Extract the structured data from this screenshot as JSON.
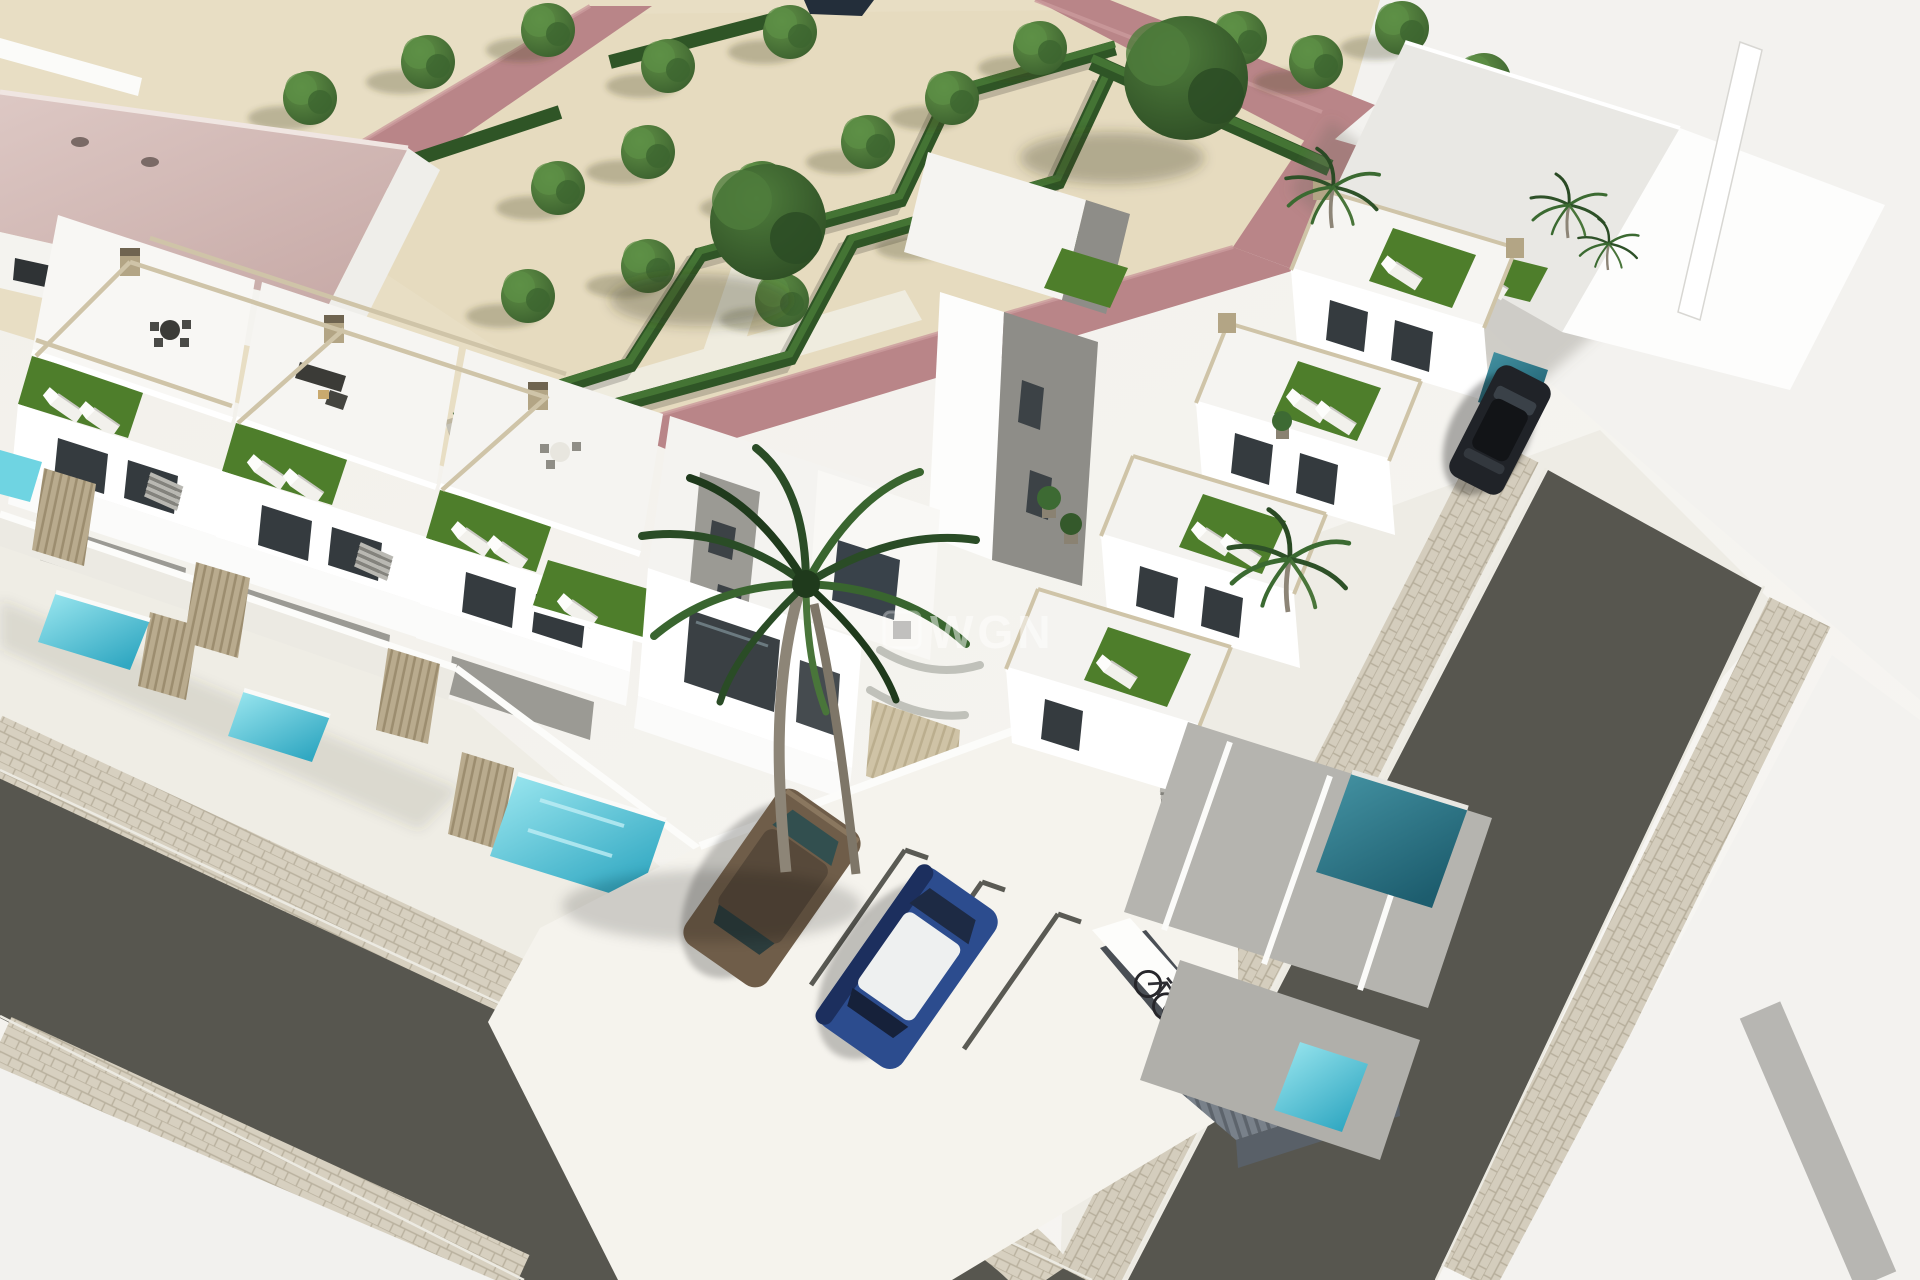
{
  "scene": {
    "type": "architectural-3d-render",
    "description": "Aerial 3D render of a new-build residential complex: two diagonal rows of modern white townhouses with rooftop solarium terraces (artificial turf, sun loungers, rattan sofas, pergola frames), private turquoise plunge pools behind slatted fences, a landscaped park with zig-zag hedges, gravel and dusty-pink paths, a corner street intersection with paver sidewalks, parked cars, bicycles and palm trees.",
    "watermark": {
      "text": "WGN",
      "opacity": 0.5
    },
    "inventory": {
      "townhouses_left_row": 4,
      "townhouses_right_row": 4,
      "plunge_pools": 7,
      "rooftop_turf_terraces": 9,
      "palm_trees": 6,
      "park_trees_small": 20,
      "park_trees_large": 2,
      "bicycles": 3,
      "streets": 2,
      "cars": [
        {
          "id": "car-bronze",
          "color_name": "bronze-brown"
        },
        {
          "id": "car-blue",
          "color_name": "blue with white roof"
        },
        {
          "id": "car-black",
          "color_name": "black"
        }
      ]
    }
  },
  "palette": {
    "sand": "#e8dec4",
    "parkInner": "#e6dbbf",
    "pathPink": "#b98588",
    "hedge": "#2f5526",
    "hedgeLight": "#447434",
    "roofMauve": "#d5bebb",
    "wallWhite": "#ffffff",
    "wallLight": "#f6f5f2",
    "wallShade": "#d6d5d1",
    "wallDark": "#9b9a94",
    "glass": "#353b3f",
    "turfRoof": "#4e7e2b",
    "poolBright": "#6fd4e2",
    "poolTeal": "#2e7d8e",
    "road": "#57564f",
    "paver": "#d7d0c0",
    "paverLine": "#b9b19e",
    "groundWhite": "#f2f0ea",
    "fence": "#b9ab8e",
    "pergola": "#cfc4a8",
    "carBronze": "#6f5d49",
    "carBlue": "#2c4c8e",
    "carBlack": "#202328",
    "watermark": "#ffffff"
  }
}
